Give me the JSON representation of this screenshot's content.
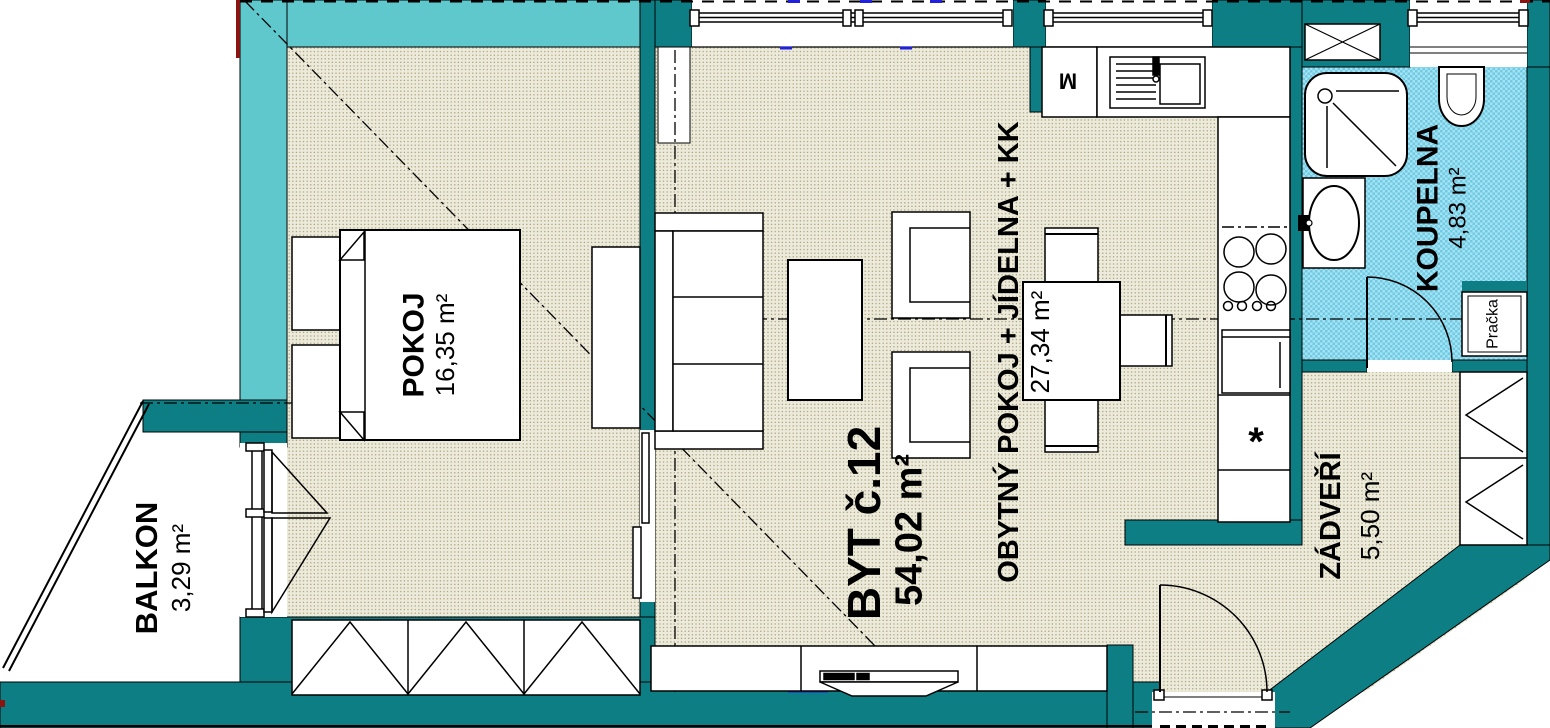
{
  "apartment": {
    "title": "BYT č.12",
    "title_area": "54,02 m²"
  },
  "rooms": {
    "pokoj": {
      "name": "POKOJ",
      "area": "16,35 m²"
    },
    "obytny_pokoj": {
      "name": "OBYTNÝ POKOJ + JÍDELNA + KK",
      "area": "27,34 m²"
    },
    "koupelna": {
      "name": "KOUPELNA",
      "area": "4,83 m²"
    },
    "zadveri": {
      "name": "ZÁDVEŘÍ",
      "area": "5,50 m²"
    },
    "balkon": {
      "name": "BALKON",
      "area": "3,29 m²"
    }
  },
  "appliances": {
    "washing_machine": "Pračka",
    "kitchen_cabinet": "M",
    "fridge_symbol": "*"
  },
  "colors": {
    "wall_dark_teal": "#0d7f84",
    "wall_light_turquoise": "#5fc8cd",
    "floor_beige": "#eceada",
    "floor_dot": "#a59c72",
    "bathroom_blue": "#8fd9ec",
    "line_black": "#000000",
    "accent_red": "#8c1410",
    "accent_blue": "#2020dd"
  }
}
